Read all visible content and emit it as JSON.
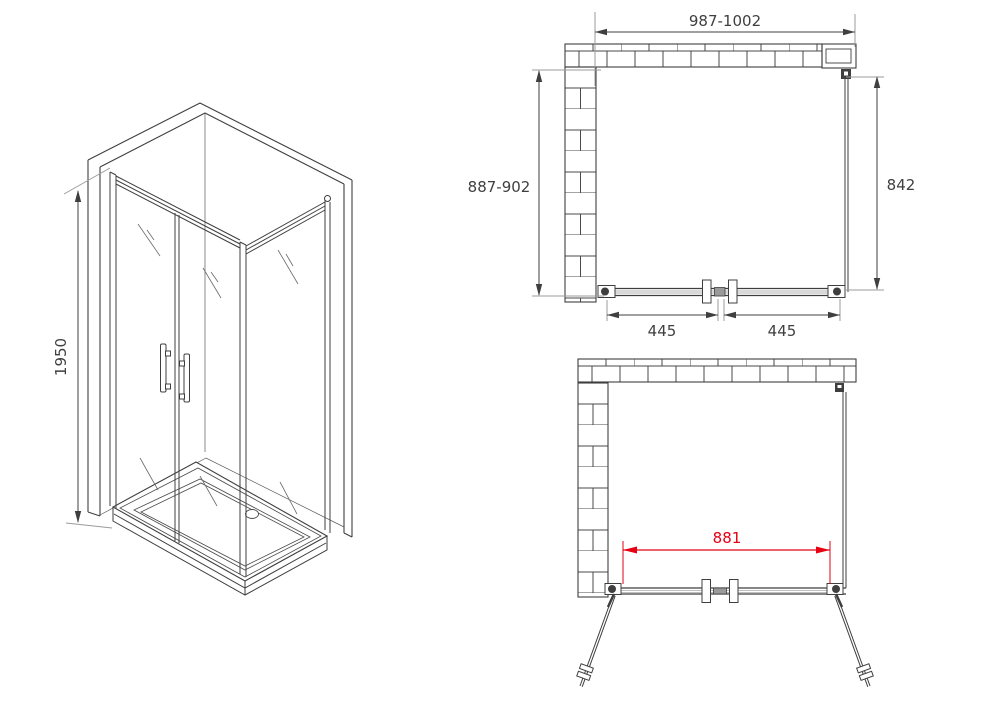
{
  "colors": {
    "line": "#3f3f3f",
    "extension_line": "#9b9b9b",
    "accent_red": "#e60012",
    "background": "#ffffff"
  },
  "isometric": {
    "height_mm": "1950"
  },
  "plan_closed": {
    "overall_width_mm": "987-1002",
    "depth_mm": "887-902",
    "side_panel_mm": "842",
    "left_door_mm": "445",
    "right_door_mm": "445"
  },
  "plan_open": {
    "opening_width_mm": "881"
  }
}
